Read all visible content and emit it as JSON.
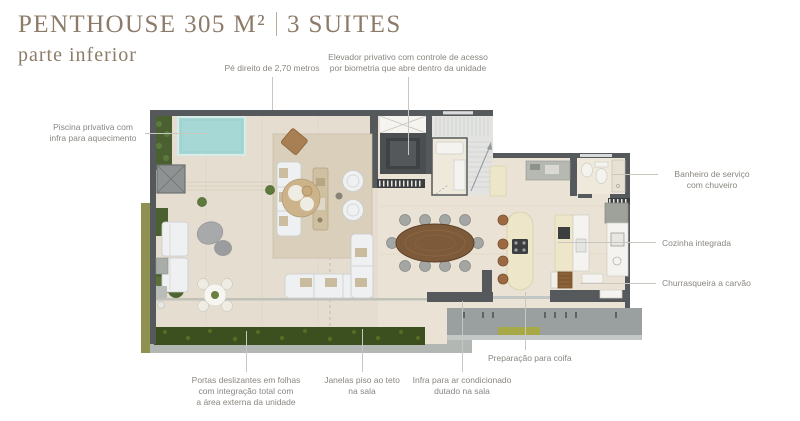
{
  "header": {
    "title_main": "PENTHOUSE 305 M²",
    "title_divider": "|",
    "title_suites": "3 SUITES",
    "subtitle": "parte inferior"
  },
  "callouts": {
    "ceiling": "Pé direito de 2,70 metros",
    "elevator": "Elevador privativo com controle de acesso\npor biometria que abre dentro da unidade",
    "pool": "Piscina privativa com\ninfra para aquecimento",
    "service_bathroom": "Banheiro de serviço\ncom chuveiro",
    "kitchen": "Cozinha integrada",
    "barbecue": "Churrasqueira a carvão",
    "sliding_doors": "Portas deslizantes em folhas\ncom integração total com\na área externa da unidade",
    "windows": "Janelas piso ao teto\nna sala",
    "hvac": "Infra para ar condicionado\ndutado na sala",
    "hood": "Preparação para coifa"
  },
  "colors": {
    "title": "#8c7b68",
    "label_text": "#8a8680",
    "leader_line": "#c9c6c0",
    "wall": "#55595b",
    "floor_interior": "#eae3d5",
    "floor_terrace": "#e5ded0",
    "rug": "#d9cfba",
    "pool_water": "#a6d9d5",
    "hedge": "#3c501f",
    "grass": "#8f9150",
    "planter_green": "#a6a945",
    "wood_table": "#7d5a3a",
    "island_cream": "#ede6c8",
    "stool_brown": "#9c6a42",
    "balcony_slab": "#9aa0a0",
    "sofa_white": "#eef0f1",
    "counter_white": "#f4f3ef",
    "counter_gray": "#b6b8b2",
    "stair_floor": "#e3e4e2",
    "bath_floor": "#efe9dc"
  }
}
